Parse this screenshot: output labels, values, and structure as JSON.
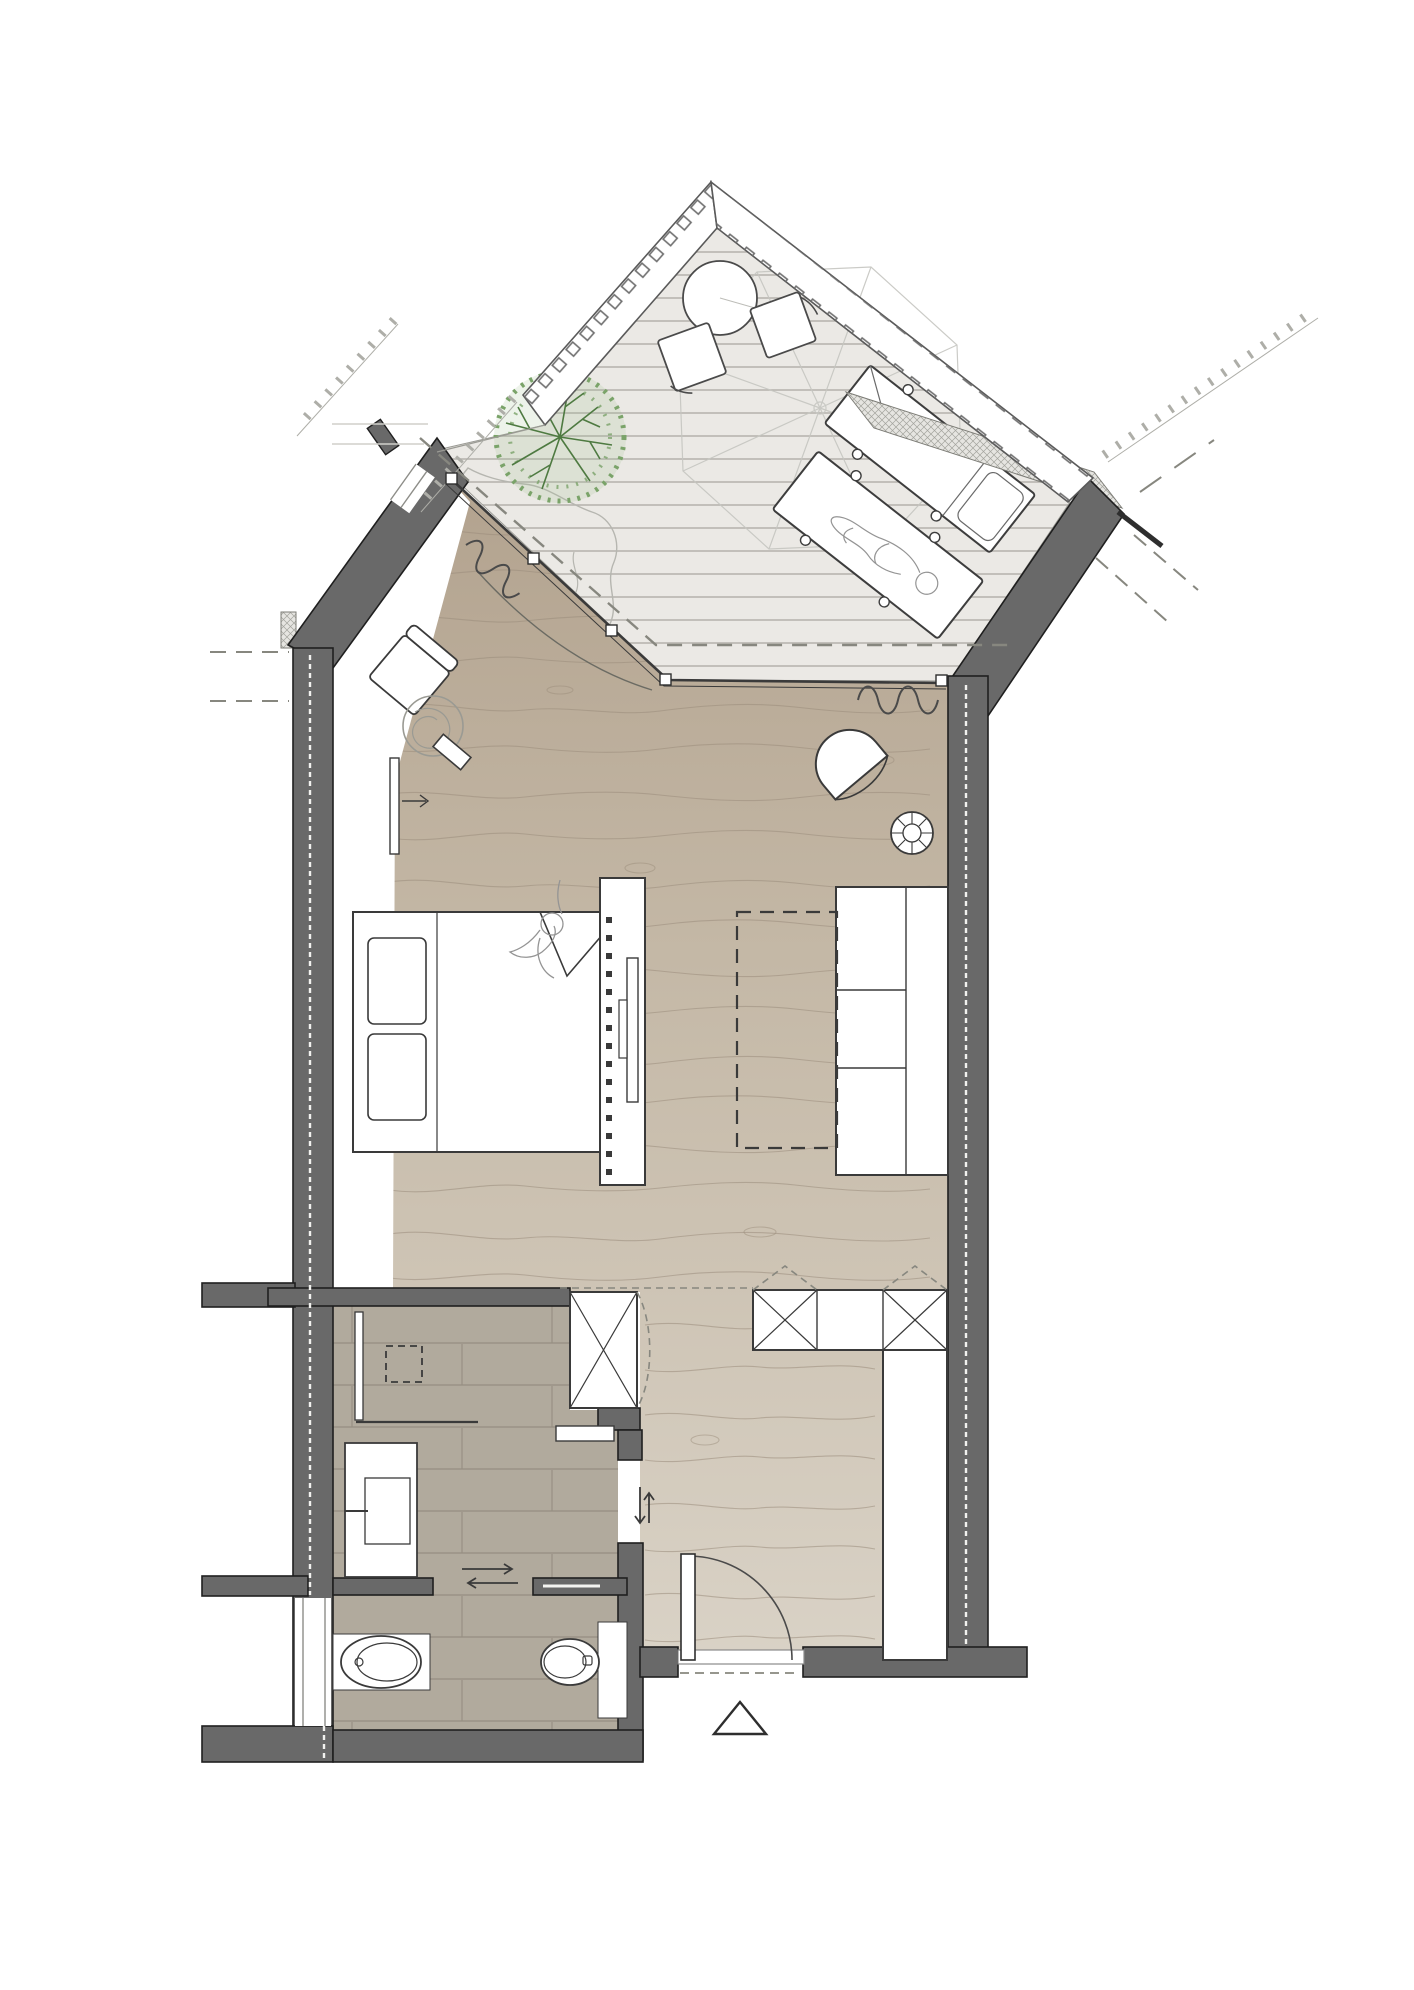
{
  "meta": {
    "kind": "architectural-floor-plan",
    "view": "top-down hotel suite with roof terrace",
    "rooms": [
      "terrace",
      "bedroom-living-room",
      "entry",
      "bathroom",
      "wc"
    ]
  },
  "colors": {
    "white": "#ffffff",
    "wall": "#696969",
    "wall_outline": "#1f1f1f",
    "insulation_bg": "#e6e5e1",
    "insulation_line": "#a3a39d",
    "deck": "#ebe9e5",
    "deck_line": "#b4b1ab",
    "deck_edge": "#9a9a94",
    "balustrade_tick": "#6f6f6f",
    "balustrade_edge": "#5a5a5a",
    "wood_top": "#b2a28e",
    "wood_mid": "#c4b8a6",
    "wood_bottom": "#dad3c7",
    "wood_grain": "#9b8d7c",
    "tile": "#b1aa9d",
    "tile_line": "#958e81",
    "fixture_stroke": "#3a3a3a",
    "tree_leaf": "#7aa369",
    "tree_branch": "#4e7a41",
    "tree_fill": "#9bbd8a",
    "shrub": "#b6b6b0",
    "umbrella": "#c6c6c1",
    "dash": "#87877f",
    "curtain": "#4a4a4a",
    "figure": "#949494",
    "joint": "#f2f2ef",
    "neighbor": "#aeaea8",
    "faint": "#d0cfca"
  },
  "objects": [
    "terrace-deck",
    "balustrade-left",
    "balustrade-right",
    "neighbor-railing",
    "parasol",
    "round-table",
    "cube-stool",
    "cube-stool",
    "tree",
    "shrub-outline",
    "sun-lounger",
    "sun-lounger-occupied",
    "roof-overhang-dashed-line",
    "sliding-glass-door",
    "curtain-left",
    "curtain-right",
    "door-slide-arc",
    "armchair-with-floor-lamp",
    "side-table",
    "radiator",
    "double-bed",
    "pillow",
    "pillow",
    "duvet-fold",
    "standing-person",
    "tv-partition",
    "tv-screen",
    "tv-bracket",
    "sofa",
    "rug-dashed-outline",
    "lounge-chair",
    "pouf",
    "wardrobe-x-left",
    "wardrobe-band",
    "wardrobe-x-cell",
    "wardrobe-plain-cell",
    "tall-closet",
    "entry-door",
    "door-swing-arc",
    "threshold",
    "entrance-triangle-marker",
    "shower-glass",
    "floor-drain",
    "vanity-sink",
    "wall-shelf",
    "towel-rail",
    "toilet",
    "bidet",
    "sliding-door-arrows",
    "bathroom-sliding-door-arrow",
    "window-left",
    "window-angled"
  ],
  "counts": {
    "sun_loungers": 2,
    "cube_stools": 2,
    "x_wardrobe_cells": 3,
    "pillows": 2
  }
}
